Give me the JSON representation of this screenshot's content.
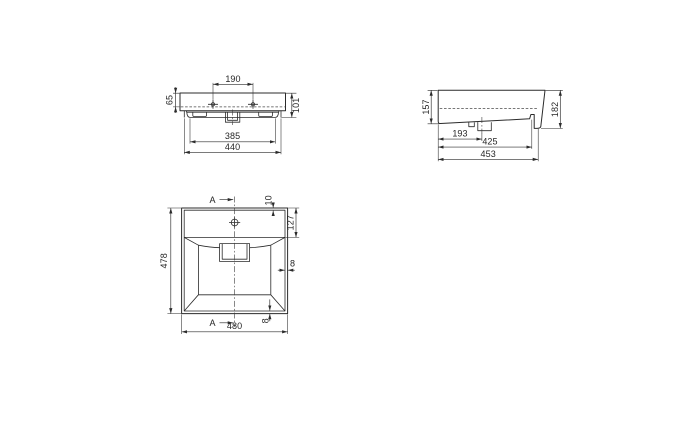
{
  "drawing": {
    "description": "washbasin technical drawing, three orthographic views",
    "background_color": "#ffffff",
    "line_color": "#2b2b2b",
    "views": {
      "front": {
        "name": "front elevation",
        "dims": {
          "hole_spacing": "190",
          "rim_to_waterline": "65",
          "front_height": "101",
          "underbody_width": "385",
          "skirt_width": "440"
        }
      },
      "side": {
        "name": "side elevation",
        "dims": {
          "front_height": "157",
          "back_height": "182",
          "drain_from_front": "193",
          "recess_depth": "425",
          "total_depth": "453"
        }
      },
      "plan": {
        "name": "top plan",
        "section_marker": "A",
        "dims": {
          "overall_depth": "478",
          "overall_width": "480",
          "top_rim": "10",
          "deck_depth": "127",
          "side_wall": "8",
          "bottom_wall": "8"
        }
      }
    }
  }
}
